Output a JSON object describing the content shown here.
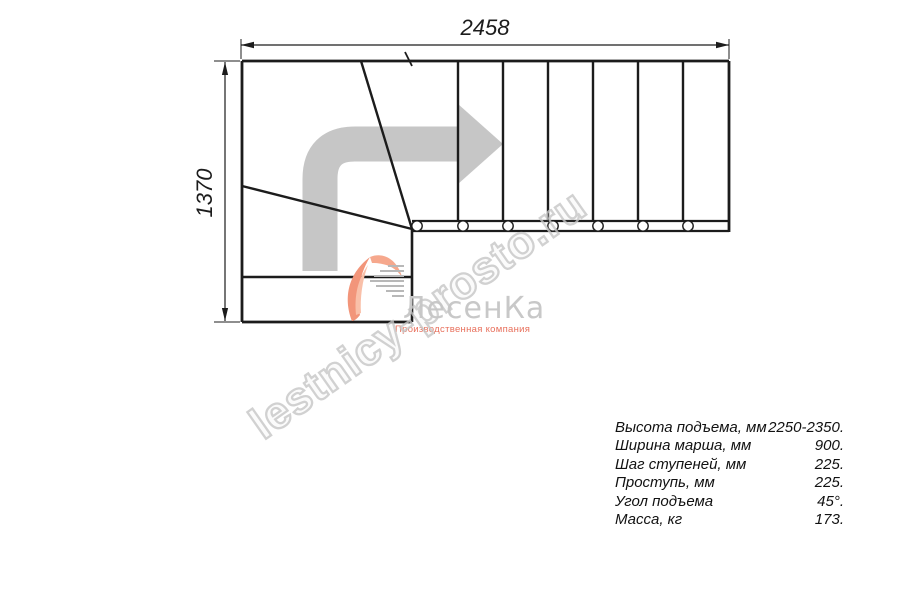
{
  "drawing": {
    "type": "staircase-plan-L-shaped-with-winders",
    "top_dimension_mm": "2458",
    "left_dimension_mm": "1370",
    "straight_tread_count": 7,
    "winder_line_count": 2,
    "baluster_count": 7,
    "line_color": "#1c1c1c",
    "direction_arrow_color": "#c6c6c6",
    "direction_arrow_meaning": "ascent-turn-right"
  },
  "watermark": {
    "text": "lestnicy-prosto.ru",
    "color": "#c6c6c6"
  },
  "logo": {
    "name": "ЛесенКа",
    "tagline": "Производственная компания",
    "name_color": "#c8c8c8",
    "tagline_color": "#e8705c",
    "swoosh_color": "#f2957a"
  },
  "specs": {
    "rows": [
      {
        "label": "Высота подъема, мм",
        "value": "2250-2350."
      },
      {
        "label": "Ширина марша, мм",
        "value": "900."
      },
      {
        "label": "Шаг ступеней, мм",
        "value": "225."
      },
      {
        "label": "Проступь, мм",
        "value": "225."
      },
      {
        "label": "Угол подъема",
        "value": "45°."
      },
      {
        "label": "Масса, кг",
        "value": "173."
      }
    ]
  }
}
